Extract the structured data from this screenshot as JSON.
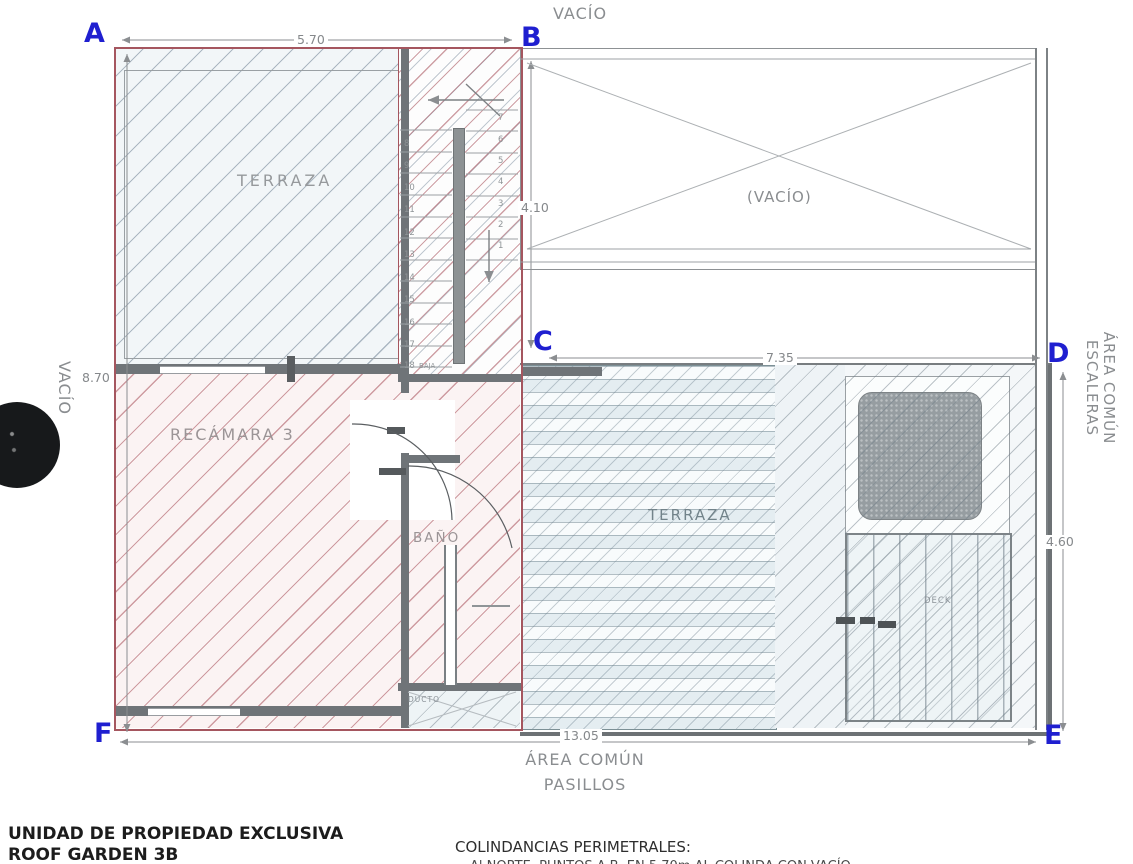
{
  "points": {
    "a": "A",
    "b": "B",
    "c": "C",
    "d": "D",
    "e": "E",
    "f": "F"
  },
  "labels": {
    "vacio_top": "VACÍO",
    "vacio_center": "(VACÍO)",
    "vacio_left": "VACÍO",
    "area_comun_escaleras_line1": "ÁREA COMÚN",
    "area_comun_escaleras_line2": "ESCALERAS",
    "area_comun_pasillos_line1": "ÁREA COMÚN",
    "area_comun_pasillos_line2": "PASILLOS",
    "terraza_upper": "TERRAZA",
    "terraza_lower": "TERRAZA",
    "recamara": "RECÁMARA 3",
    "bano": "BAÑO",
    "ducto": "DUCTO",
    "deck": "DECK"
  },
  "dimensions": {
    "top": "5.70",
    "left": "8.70",
    "stair_void": "4.10",
    "middle": "7.35",
    "right": "4.60",
    "bottom": "13.05"
  },
  "stairs": {
    "left": [
      "8",
      "9",
      "10",
      "11",
      "12",
      "13",
      "14",
      "15",
      "16",
      "17",
      "18"
    ],
    "right": [
      "7",
      "6",
      "5",
      "4",
      "3",
      "2",
      "1"
    ],
    "baja": "BAJA"
  },
  "footer": {
    "unit_line1": "UNIDAD DE PROPIEDAD EXCLUSIVA",
    "unit_line2": "ROOF GARDEN 3B",
    "colindancias_heading": "COLINDANCIAS PERIMETRALES:",
    "colindancias_line1": "Al NORTE, PUNTOS  A-B, EN  5.70m  AL COLINDA CON VACÍO"
  },
  "colors": {
    "point_blue": "#1f1fd0",
    "unit_red": "#a5565f",
    "wall_gray": "#6f7478",
    "dim_gray": "#8a8d90",
    "teal_border": "#7c9096"
  }
}
